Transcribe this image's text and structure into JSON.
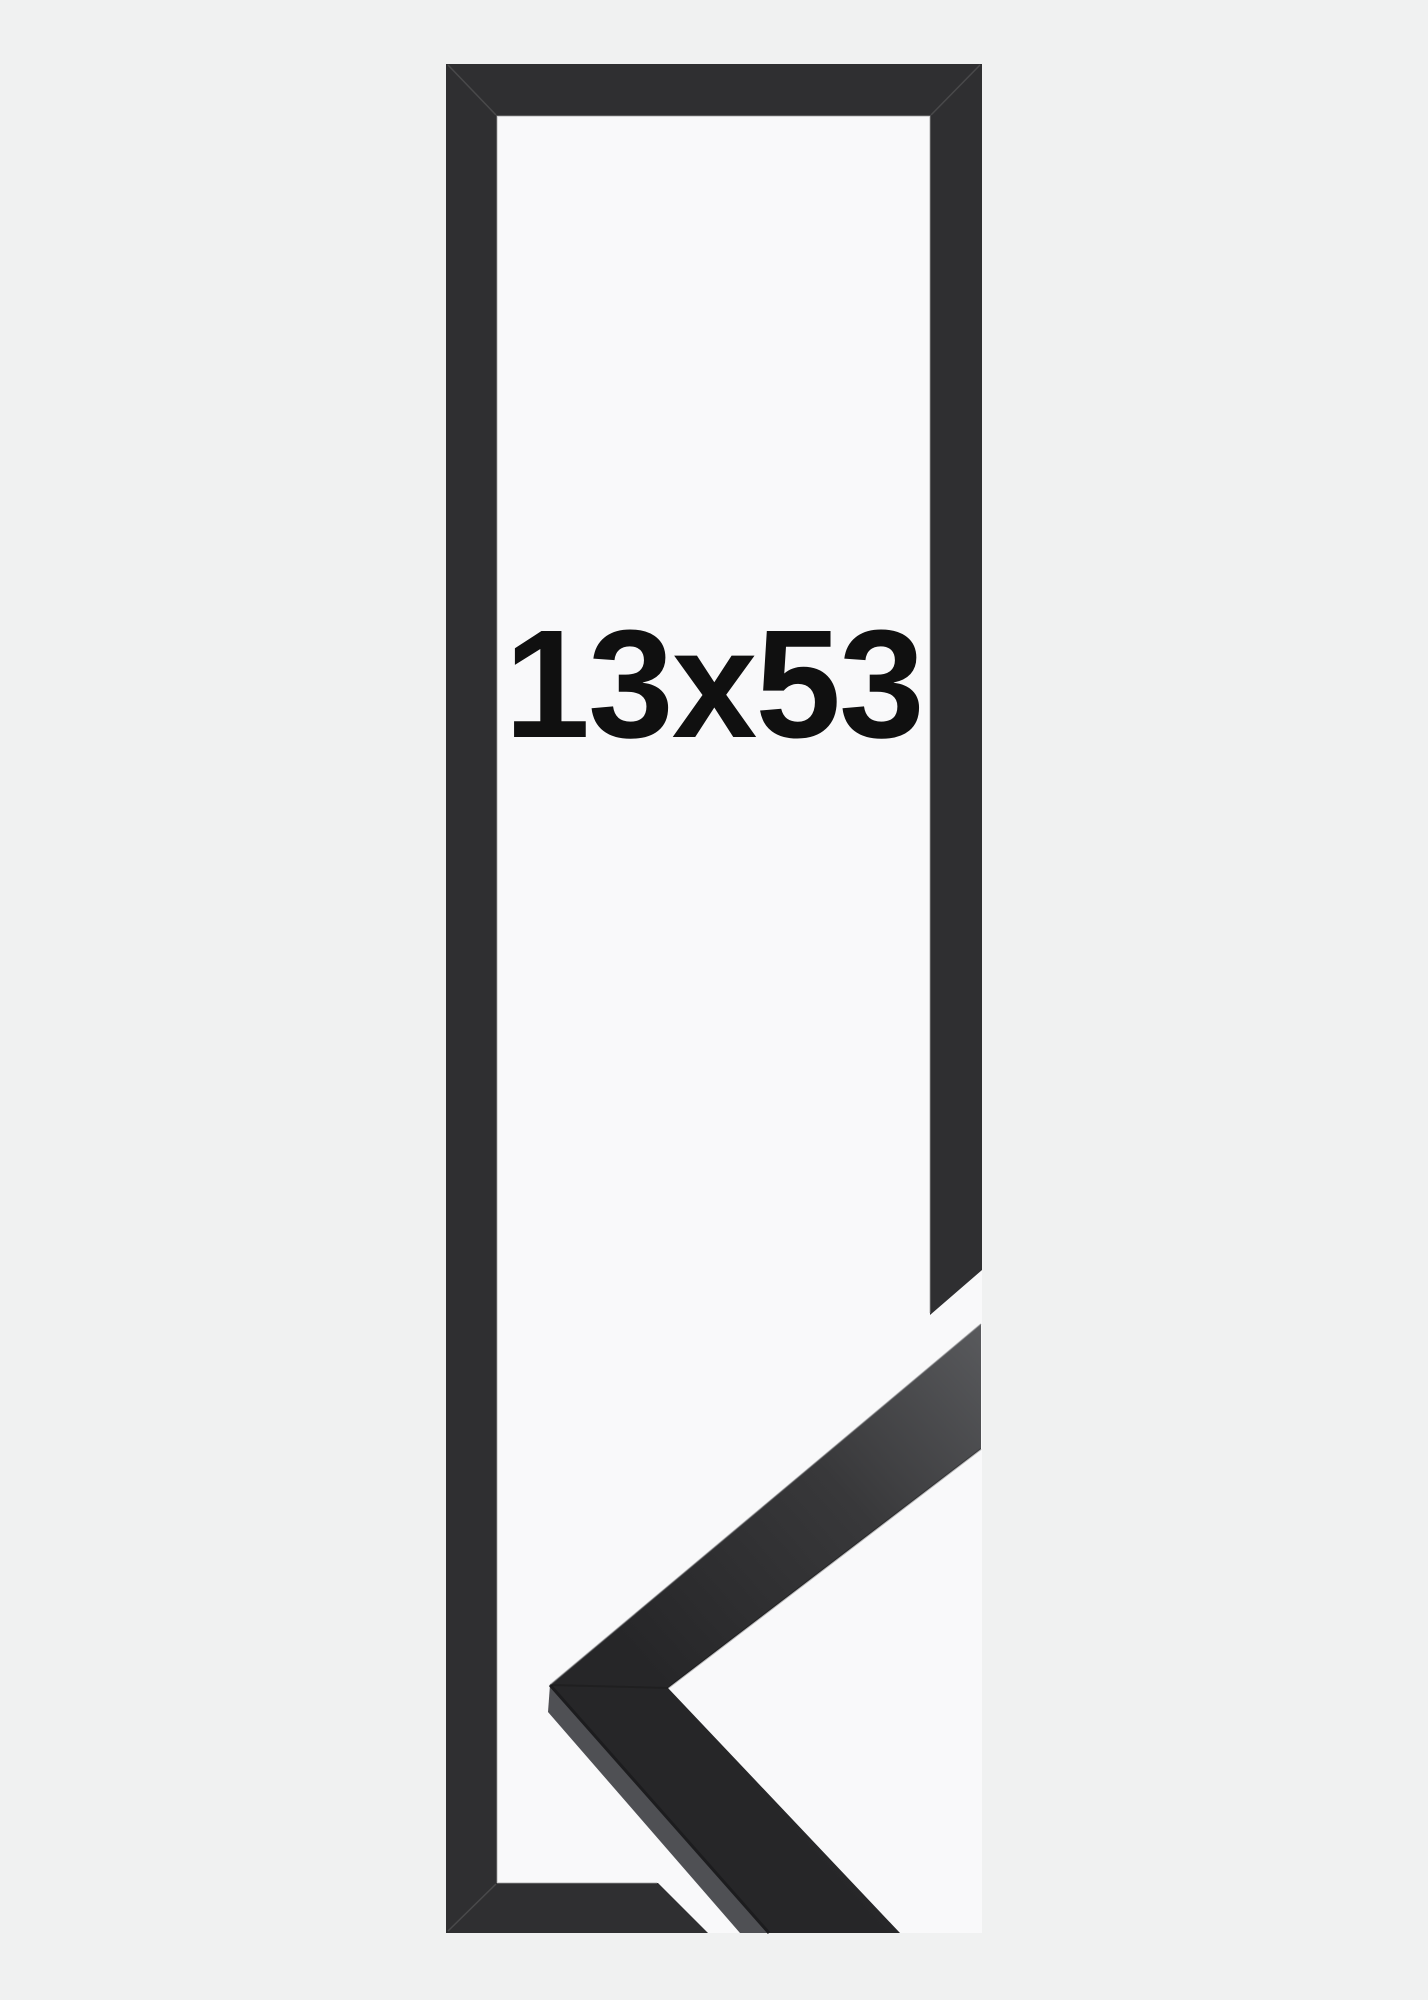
{
  "product_image": {
    "size_label": {
      "text": "13x53"
    },
    "colors": {
      "canvas_bg": "#f0f1f1",
      "photo_white": "#f9f9fa",
      "frame_dark": "#2f2f31",
      "moulding_face_light": "#595a5d",
      "moulding_face_mid": "#38383a",
      "moulding_face_dark": "#262628",
      "moulding_side": "#4f5054",
      "crease_dark": "#1c1c1e",
      "edge_highlight": "#9b9c9e",
      "label_color": "#101010"
    }
  }
}
